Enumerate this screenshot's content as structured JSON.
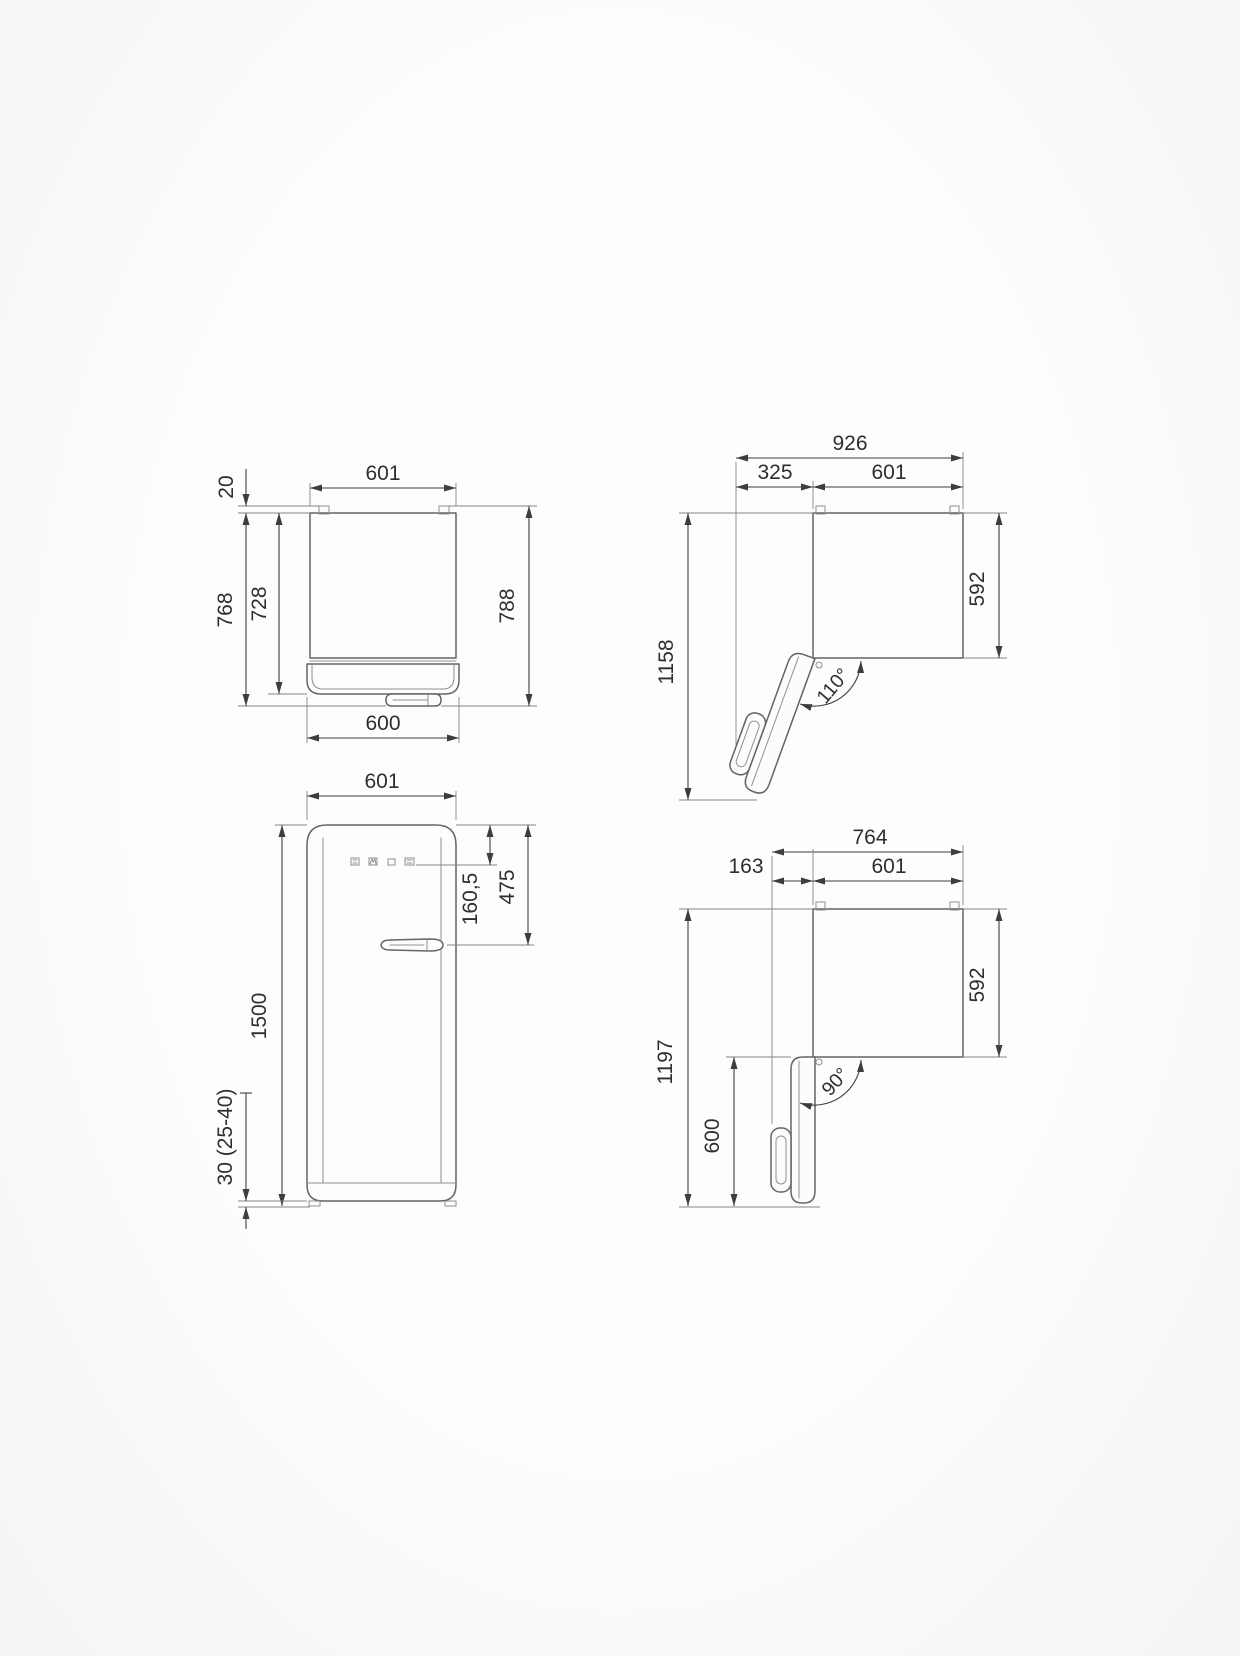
{
  "page": {
    "background_color": "#fcfcfc",
    "drawing_line_color": "#646464",
    "dimension_line_color": "#3d3d3d",
    "text_color": "#2e2e2e",
    "description": "Appliance dimension drawing, four orthographic views of a single-door refrigerator, measurements in mm"
  },
  "views": {
    "top_closed": {
      "name": "top view, door closed",
      "width_top": "601",
      "hinge_gap": "20",
      "depth_to_handle": "768",
      "depth_to_door": "728",
      "depth_overall": "788",
      "width_bottom": "600"
    },
    "top_open_110": {
      "name": "top view, door open 110 degrees",
      "overall_width": "926",
      "door_projection": "325",
      "body_width": "601",
      "overall_depth": "1158",
      "body_depth": "592",
      "door_angle": "110°"
    },
    "front": {
      "name": "front view",
      "width": "601",
      "top_to_panel": "160,5",
      "top_to_handle": "475",
      "height": "1500",
      "feet_height": "30 (25-40)"
    },
    "top_open_90": {
      "name": "top view, door open 90 degrees",
      "overall_width": "764",
      "door_projection": "163",
      "body_width": "601",
      "overall_depth": "1197",
      "body_depth": "592",
      "door_length": "600",
      "door_angle": "90°"
    }
  }
}
